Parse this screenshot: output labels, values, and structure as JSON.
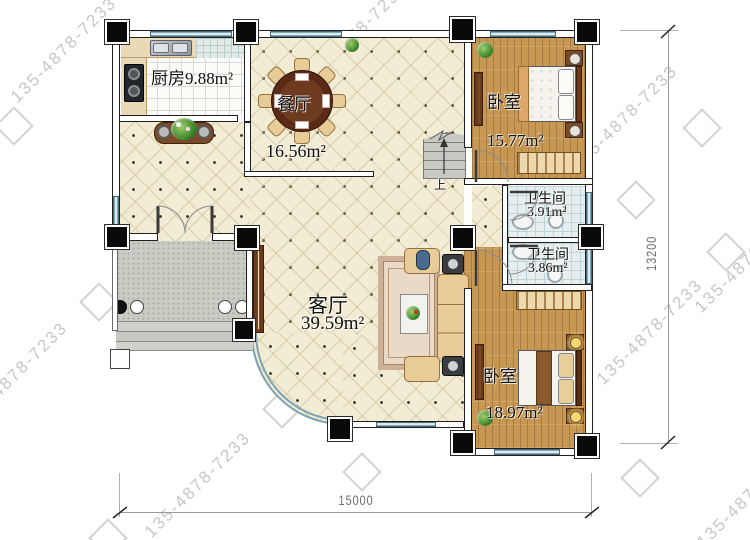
{
  "plan": {
    "type": "floor-plan",
    "rooms": [
      {
        "id": "kitchen",
        "label": "厨房",
        "area": "9.88m²",
        "label_combined": "厨房9.88m²"
      },
      {
        "id": "dining",
        "label": "餐厅",
        "area": "16.56m²"
      },
      {
        "id": "bedroom-top",
        "label": "卧室",
        "area": "15.77m²"
      },
      {
        "id": "bath-top",
        "label": "卫生间",
        "area": "3.91m²"
      },
      {
        "id": "bath-bottom",
        "label": "卫生间",
        "area": "3.86m²"
      },
      {
        "id": "living",
        "label": "客厅",
        "area": "39.59m²"
      },
      {
        "id": "bedroom-bottom",
        "label": "卧室",
        "area": "18.97m²"
      }
    ],
    "stairs": {
      "direction_label": "上"
    },
    "dimensions": {
      "bottom_width": "15000",
      "right_height": "13200"
    }
  },
  "watermark": {
    "text": "135-4878-7233"
  },
  "colors": {
    "wall": "#202020",
    "tile_floor": "#f3ecd4",
    "wood_floor": "#c79754",
    "bath_floor": "#e6eef0",
    "kitchen_floor": "#fbfbf7",
    "porch": "#caccc4",
    "window": "#7ea9b8",
    "watermark": "#c7c7c7",
    "dimension_text": "#6f6f6f"
  }
}
